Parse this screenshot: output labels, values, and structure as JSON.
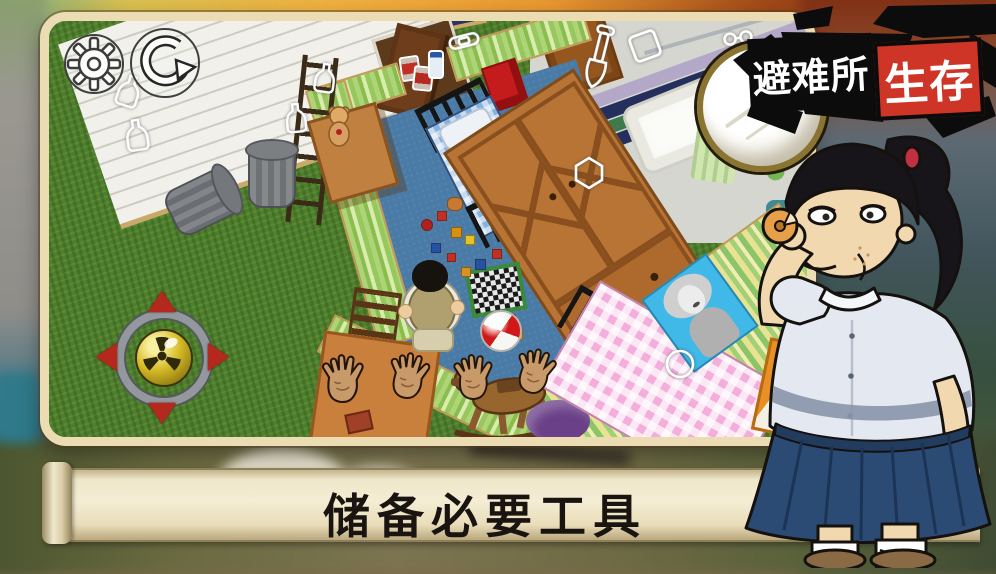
{
  "game": {
    "logo": {
      "part1": "避难所",
      "part2": "生存",
      "part1_bg": "#0c0c0c",
      "part2_bg": "#cf3526",
      "text_color": "#ffffff",
      "decorations": [
        "ink-splash",
        "magnifying-glass",
        "red-bow"
      ]
    },
    "caption": {
      "text": "储备必要工具",
      "panel": "parchment-scroll",
      "panel_color": "#efe6c8",
      "text_color": "#191410"
    }
  },
  "hud": {
    "settings_button": {
      "icon": "gear"
    },
    "restart_button": {
      "icon": "circular-arrow"
    },
    "joystick": {
      "center_icon": "radiation-trefoil",
      "arrow_color": "#b5281e",
      "ring_color": "#92989e",
      "center_color": "#d8bc28"
    }
  },
  "scene": {
    "outdoor_items": [
      "grass",
      "wooden-deck",
      "purple-carpet",
      "trash-can-standing",
      "trash-can-tipped",
      "ladder"
    ],
    "bedroom_items": [
      "open-door",
      "hallway-paper",
      "metal-bed-blue-plaid",
      "wardrobe",
      "desk-with-teddy-bear",
      "red-poster",
      "chessboard",
      "dice",
      "beach-ball",
      "toy-blocks",
      "child-top-view",
      "chair",
      "rocking-horse",
      "orange-table",
      "book",
      "pink-gingham-bed",
      "pinup-poster",
      "purple-pouf",
      "cartoon-hands"
    ],
    "bathroom_items": [
      "bathtub",
      "mosaic-tile-stripes",
      "towel",
      "wood-cabinet",
      "shower-rail",
      "ceiling-lamp",
      "celery",
      "orange-box"
    ],
    "outline_hints": [
      "bottle",
      "bottle",
      "bottle",
      "bottle",
      "band-aid",
      "shovel",
      "frame",
      "hexagon-jar",
      "round-lid",
      "glasses"
    ],
    "found_items": [
      "canned-food",
      "canned-food",
      "water-bottle"
    ],
    "colors": {
      "grass": "#4e7e2e",
      "carpet": "#4a7ba6",
      "wall_stripes": "#9aca62"
    }
  },
  "character": {
    "figure": "woman-eating-donut",
    "hair_color": "#17151a",
    "shirt_color": "#e4e9f1",
    "skirt_color": "#2b4a74",
    "skin_color": "#f2d8ae"
  }
}
